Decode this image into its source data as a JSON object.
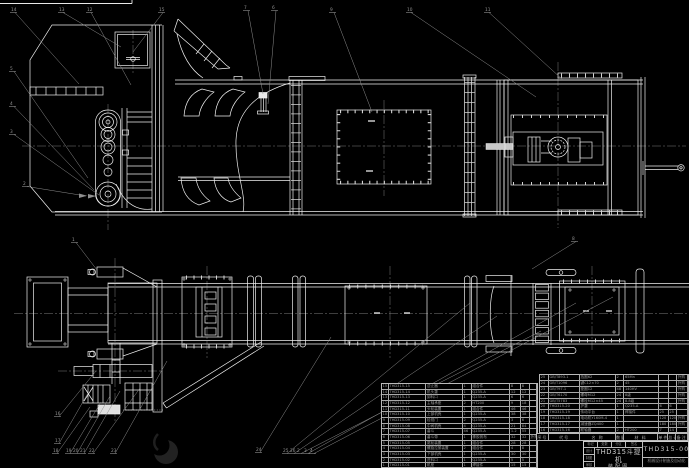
{
  "title_block": {
    "product": "THD315斗提机",
    "drawing_type": "装配图",
    "drawing_no": "THD315-00",
    "org": "机械设计制造及自动化",
    "top_cells": [
      "标记",
      "处数",
      "分区",
      "签名"
    ],
    "sig_labels": [
      "设计",
      "制图",
      "审核"
    ]
  },
  "bom": {
    "headers": [
      "序号",
      "代号",
      "名  称",
      "数量",
      "材  料",
      "单件",
      "总计",
      "备注"
    ],
    "left_rows": [
      [
        "15",
        "THD315-15",
        "逆止器",
        "1",
        "组合件",
        "8",
        "8",
        ""
      ],
      [
        "14",
        "THD315-14",
        "机头罩",
        "1",
        "Q235-A",
        "12",
        "12",
        ""
      ],
      [
        "13",
        "THD315-13",
        "卸料口",
        "1",
        "Q235-A",
        "6",
        "6",
        ""
      ],
      [
        "12",
        "THD315-12",
        "主轴承座",
        "2",
        "HT200",
        "9",
        "18",
        ""
      ],
      [
        "11",
        "THD315-11",
        "头轮装置",
        "1",
        "组合件",
        "46",
        "46",
        ""
      ],
      [
        "10",
        "THD315-10",
        "上部机壳",
        "1",
        "Q235-A",
        "38",
        "38",
        ""
      ],
      [
        "9",
        "THD315-09",
        "检视门",
        "2",
        "Q235-A",
        "3",
        "6",
        ""
      ],
      [
        "8",
        "THD315-08",
        "中间机壳",
        "4",
        "Q235-A",
        "21",
        "84",
        ""
      ],
      [
        "7",
        "THD315-07",
        "畚斗",
        "46",
        "Q235-A",
        "1.2",
        "55",
        ""
      ],
      [
        "6",
        "THD315-06",
        "畚斗带",
        "1",
        "橡胶帆布",
        "32",
        "32",
        "外购"
      ],
      [
        "5",
        "THD315-05",
        "尾轮装置",
        "1",
        "组合件",
        "28",
        "28",
        ""
      ],
      [
        "4",
        "THD315-04",
        "螺旋拉紧装置",
        "2",
        "组合件",
        "4",
        "8",
        ""
      ],
      [
        "3",
        "THD315-03",
        "下部机壳",
        "1",
        "Q235-A",
        "30",
        "30",
        ""
      ],
      [
        "2",
        "THD315-02",
        "进料口",
        "1",
        "Q235-A",
        "5",
        "5",
        ""
      ],
      [
        "1",
        "THD315-01",
        "机座",
        "1",
        "焊接件",
        "15",
        "15",
        ""
      ]
    ],
    "right_rows": [
      [
        "25",
        "GB/T893.1",
        "挡圈62",
        "2",
        "65Mn",
        "",
        "",
        "外购"
      ],
      [
        "24",
        "GB/T1096",
        "键C12×70",
        "2",
        "45",
        "",
        "",
        "外购"
      ],
      [
        "23",
        "GB/T97.1",
        "垫圈12",
        "48",
        "140HV",
        "",
        "",
        "外购"
      ],
      [
        "22",
        "GB/T6170",
        "螺母M12",
        "24",
        "8级",
        "",
        "",
        "外购"
      ],
      [
        "21",
        "GB/T5783",
        "螺栓M12×45",
        "24",
        "8.8级",
        "",
        "",
        "外购"
      ],
      [
        "20",
        "THD315-20",
        "护罩",
        "1",
        "Q235-A",
        "6",
        "6",
        ""
      ],
      [
        "19",
        "THD315-19",
        "传动平台",
        "1",
        "焊接件",
        "25",
        "25",
        ""
      ],
      [
        "18",
        "THD315-18",
        "电动机Y160M-4",
        "1",
        "",
        "120",
        "120",
        "外购"
      ],
      [
        "17",
        "THD315-17",
        "减速器ZQ400",
        "1",
        "",
        "180",
        "180",
        "外购"
      ],
      [
        "16",
        "THD315-16",
        "联轴器",
        "2",
        "HT200",
        "7",
        "14",
        ""
      ]
    ]
  },
  "callouts": [
    {
      "label": "14",
      "x": 11,
      "y": 11,
      "tx": 79,
      "ty": 84
    },
    {
      "label": "13",
      "x": 59,
      "y": 11,
      "tx": 121,
      "ty": 47
    },
    {
      "label": "12",
      "x": 87,
      "y": 11,
      "tx": 131,
      "ty": 85
    },
    {
      "label": "15",
      "x": 159,
      "y": 11,
      "tx": 133,
      "ty": 52
    },
    {
      "label": "7",
      "x": 244,
      "y": 9,
      "tx": 263,
      "ty": 94
    },
    {
      "label": "6",
      "x": 272,
      "y": 9,
      "tx": 268,
      "ty": 104
    },
    {
      "label": "9",
      "x": 330,
      "y": 11,
      "tx": 372,
      "ty": 112
    },
    {
      "label": "10",
      "x": 407,
      "y": 11,
      "tx": 536,
      "ty": 97
    },
    {
      "label": "11",
      "x": 485,
      "y": 11,
      "tx": 563,
      "ty": 80
    },
    {
      "label": "5",
      "x": 10,
      "y": 70,
      "tx": 88,
      "ty": 178
    },
    {
      "label": "4",
      "x": 10,
      "y": 105,
      "tx": 94,
      "ty": 190
    },
    {
      "label": "3",
      "x": 10,
      "y": 133,
      "tx": 99,
      "ty": 195
    },
    {
      "label": "2",
      "x": 23,
      "y": 185,
      "tx": 86,
      "ty": 196
    },
    {
      "label": "8",
      "x": 572,
      "y": 240,
      "tx": 532,
      "ty": 269
    },
    {
      "label": "1",
      "x": 72,
      "y": 241,
      "tx": 97,
      "ty": 270
    },
    {
      "label": "16",
      "x": 55,
      "y": 415,
      "tx": 96,
      "ty": 371
    },
    {
      "label": "17",
      "x": 55,
      "y": 442,
      "tx": 88,
      "ty": 393
    },
    {
      "label": "18",
      "x": 53,
      "y": 452,
      "tx": 90,
      "ty": 407
    },
    {
      "label": "19",
      "x": 66,
      "y": 452,
      "tx": 101,
      "ty": 402
    },
    {
      "label": "20",
      "x": 73,
      "y": 452,
      "tx": 110,
      "ty": 396
    },
    {
      "label": "21",
      "x": 80,
      "y": 452,
      "tx": 120,
      "ty": 391
    },
    {
      "label": "22",
      "x": 89,
      "y": 452,
      "tx": 140,
      "ty": 388
    },
    {
      "label": "23",
      "x": 111,
      "y": 452,
      "tx": 167,
      "ty": 361
    },
    {
      "label": "24",
      "x": 256,
      "y": 451,
      "tx": 331,
      "ty": 337
    },
    {
      "label": "25",
      "x": 283,
      "y": 452,
      "tx": 470,
      "ty": 303
    },
    {
      "label": "26",
      "x": 290,
      "y": 452,
      "tx": 497,
      "ty": 316
    },
    {
      "label": "2",
      "x": 297,
      "y": 452,
      "tx": 541,
      "ty": 331
    },
    {
      "label": "3",
      "x": 304,
      "y": 452,
      "tx": 576,
      "ty": 303
    },
    {
      "label": "4",
      "x": 310,
      "y": 452,
      "tx": 613,
      "ty": 297
    }
  ],
  "colors": {
    "background": "#000000",
    "line": "#f0f0f0",
    "leader": "#8f8f8f",
    "bom_text": "#9c9c9c",
    "title_text": "#cdcdcd"
  }
}
